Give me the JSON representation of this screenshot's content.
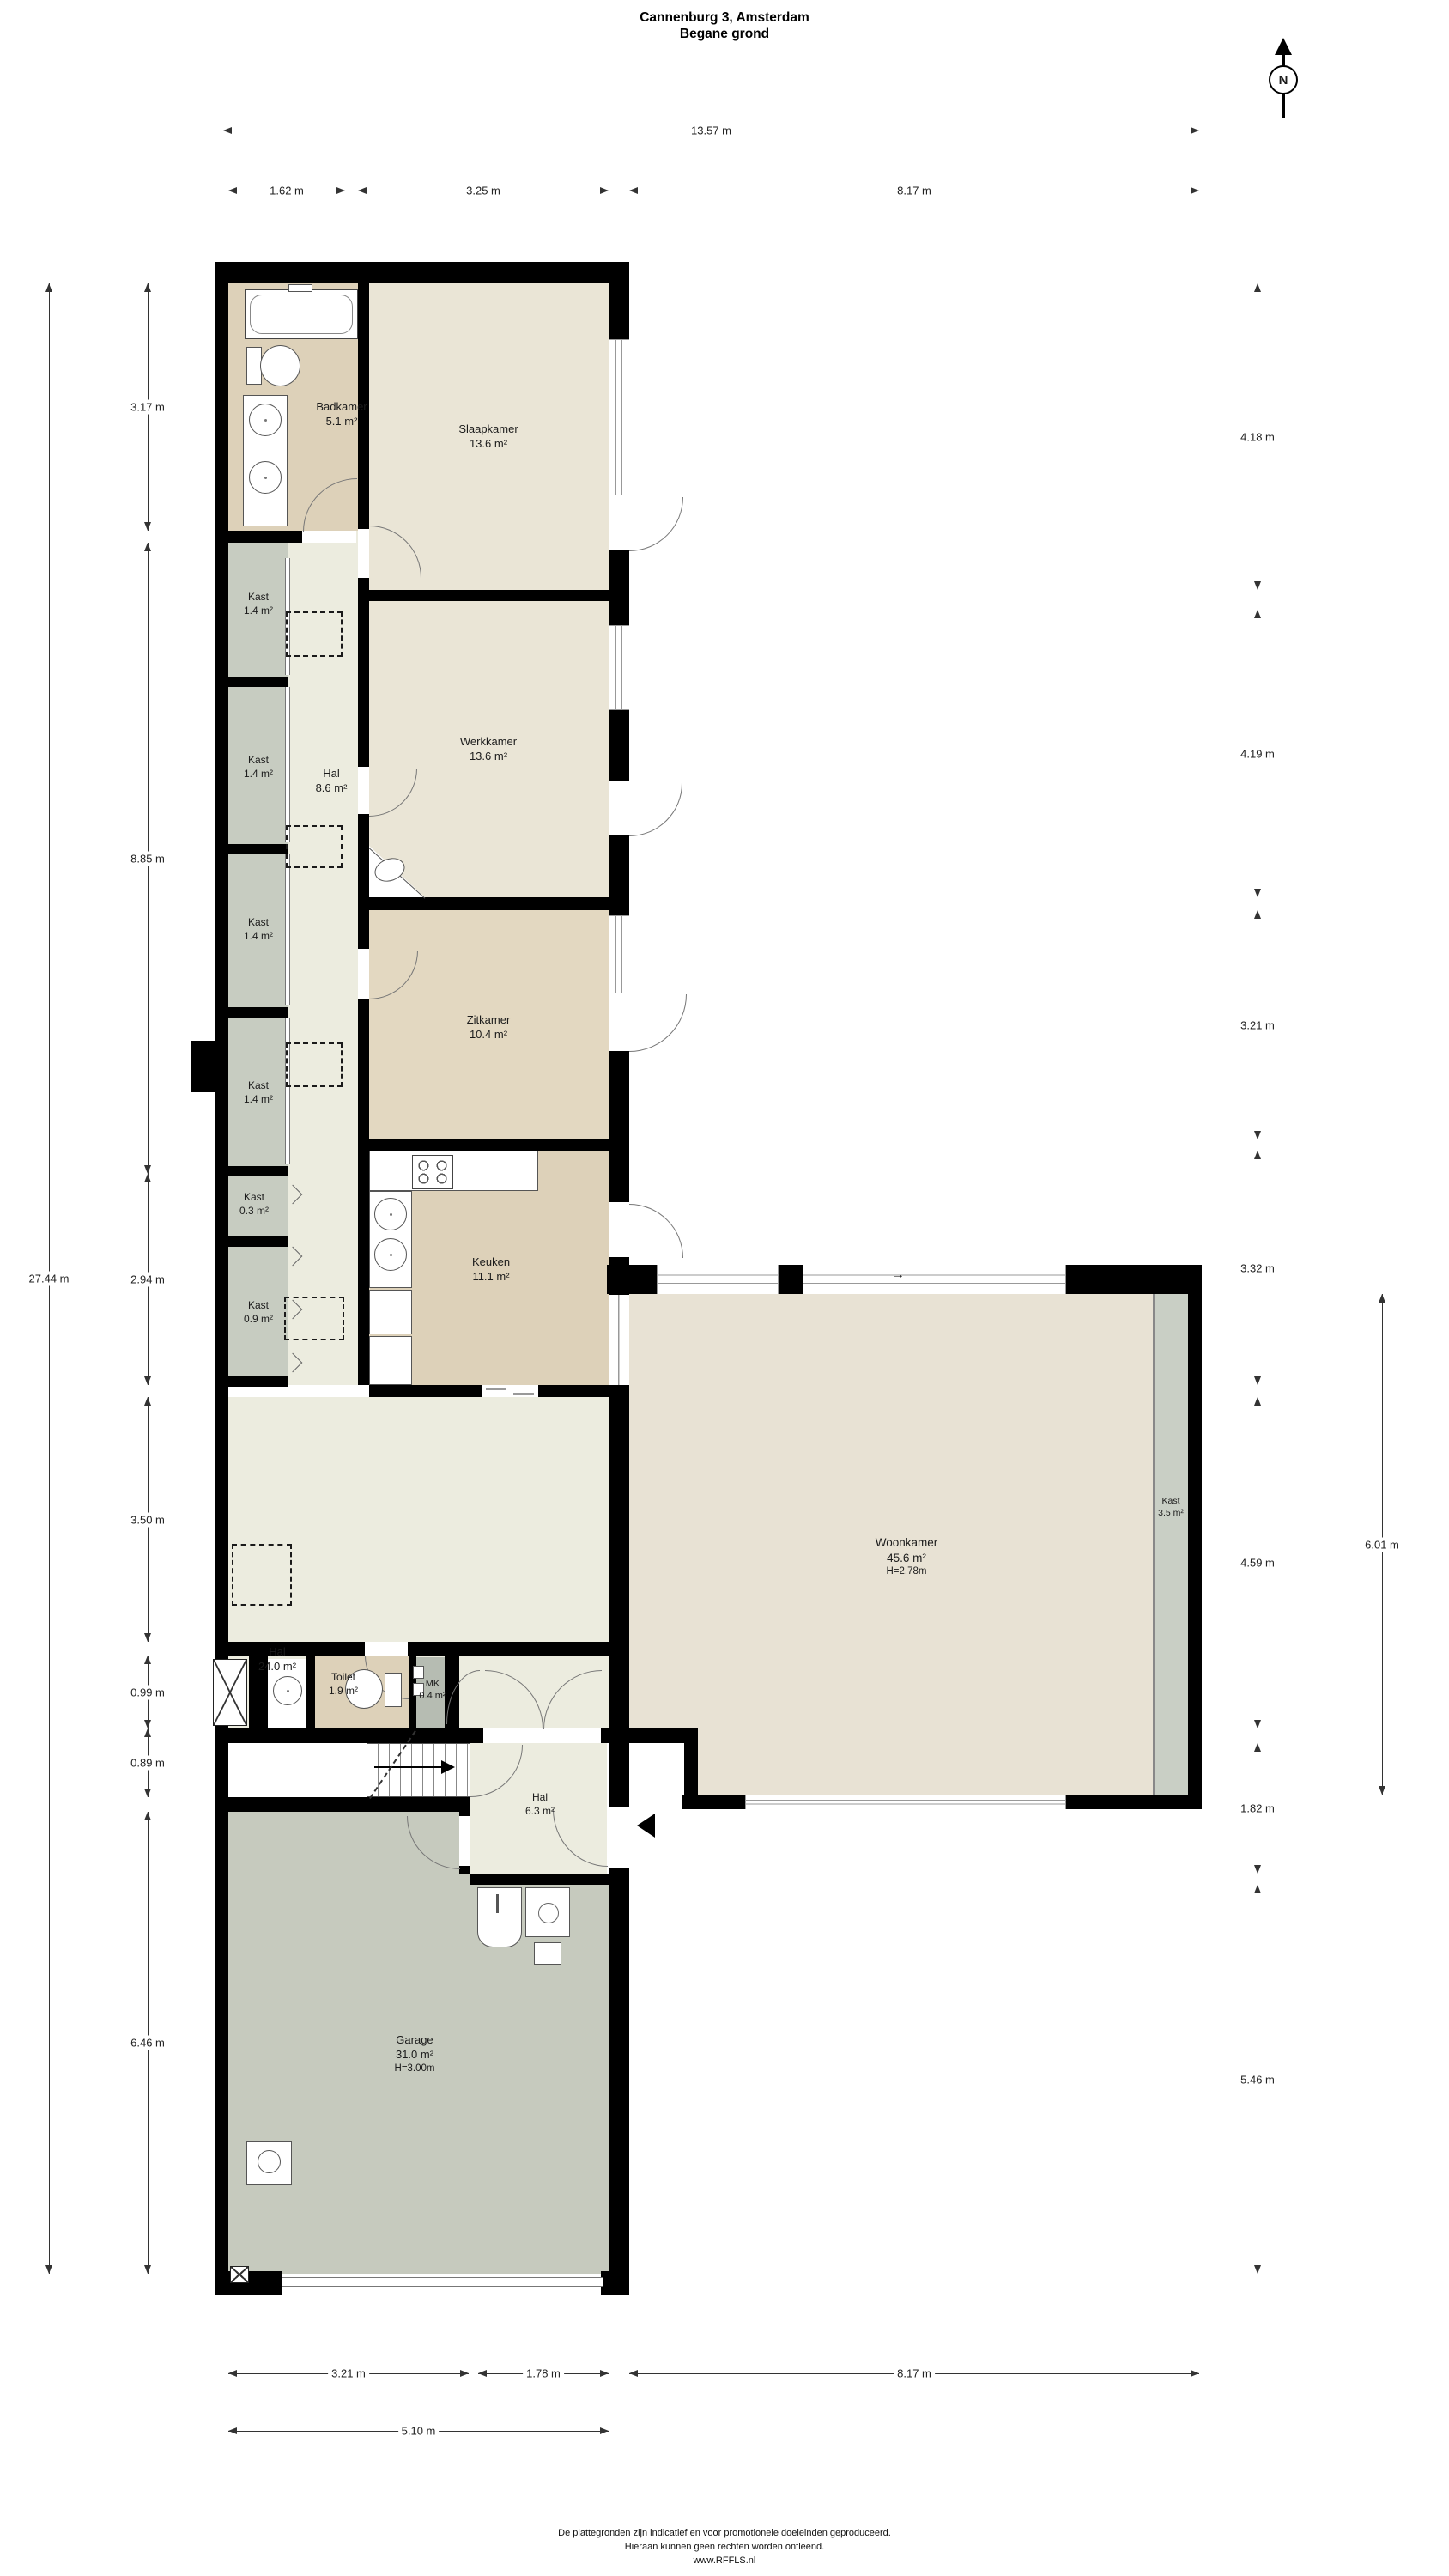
{
  "title": {
    "line1": "Cannenburg 3, Amsterdam",
    "line2": "Begane grond"
  },
  "compass": {
    "label": "N"
  },
  "rooms": {
    "badkamer": {
      "name": "Badkamer",
      "area": "5.1 m²"
    },
    "slaapkamer": {
      "name": "Slaapkamer",
      "area": "13.6 m²"
    },
    "kast1": {
      "name": "Kast",
      "area": "1.4 m²"
    },
    "kast2": {
      "name": "Kast",
      "area": "1.4 m²"
    },
    "kast3": {
      "name": "Kast",
      "area": "1.4 m²"
    },
    "kast4": {
      "name": "Kast",
      "area": "1.4 m²"
    },
    "hal86": {
      "name": "Hal",
      "area": "8.6 m²"
    },
    "werkkamer": {
      "name": "Werkkamer",
      "area": "13.6 m²"
    },
    "zitkamer": {
      "name": "Zitkamer",
      "area": "10.4 m²"
    },
    "kast03": {
      "name": "Kast",
      "area": "0.3 m²"
    },
    "keuken": {
      "name": "Keuken",
      "area": "11.1 m²"
    },
    "kast09": {
      "name": "Kast",
      "area": "0.9 m²"
    },
    "hal24": {
      "name": "Hal",
      "area": "24.0 m²"
    },
    "woonkamer": {
      "name": "Woonkamer",
      "area": "45.6 m²",
      "height": "H=2.78m"
    },
    "kast35": {
      "name": "Kast",
      "area": "3.5 m²"
    },
    "toilet": {
      "name": "Toilet",
      "area": "1.9 m²"
    },
    "mk": {
      "name": "MK",
      "area": "0.4 m²"
    },
    "hal63": {
      "name": "Hal",
      "area": "6.3 m²"
    },
    "garage": {
      "name": "Garage",
      "area": "31.0 m²",
      "height": "H=3.00m"
    }
  },
  "dimensions": {
    "top_total": "13.57 m",
    "top_segments": [
      "1.62 m",
      "3.25 m",
      "8.17 m"
    ],
    "bottom_segments": [
      "3.21 m",
      "1.78 m",
      "8.17 m"
    ],
    "bottom_total": "5.10 m",
    "left": [
      "3.17 m",
      "8.85 m",
      "2.94 m",
      "3.50 m",
      "0.99 m",
      "0.89 m",
      "6.46 m"
    ],
    "left_total": "27.44 m",
    "right": [
      "4.18 m",
      "4.19 m",
      "3.21 m",
      "3.32 m",
      "4.59 m",
      "1.82 m",
      "5.46 m"
    ],
    "right_inner": "6.01 m"
  },
  "annotations": {
    "flow_arrow": "→"
  },
  "footer": {
    "line1": "De plattegronden zijn indicatief en voor promotionele doeleinden geproduceerd.",
    "line2": "Hieraan kunnen geen rechten worden ontleend.",
    "line3": "www.RFFLS.nl"
  },
  "colors": {
    "wall": "#000000",
    "floor_bathroom": "#ddd1b9",
    "floor_bedroom": "#eae5d6",
    "floor_sitting": "#e3d8c1",
    "floor_living": "#e8e2d4",
    "floor_hall": "#ececе5",
    "floor_closet": "#c7ccc1",
    "floor_garage": "#c6cabe"
  }
}
